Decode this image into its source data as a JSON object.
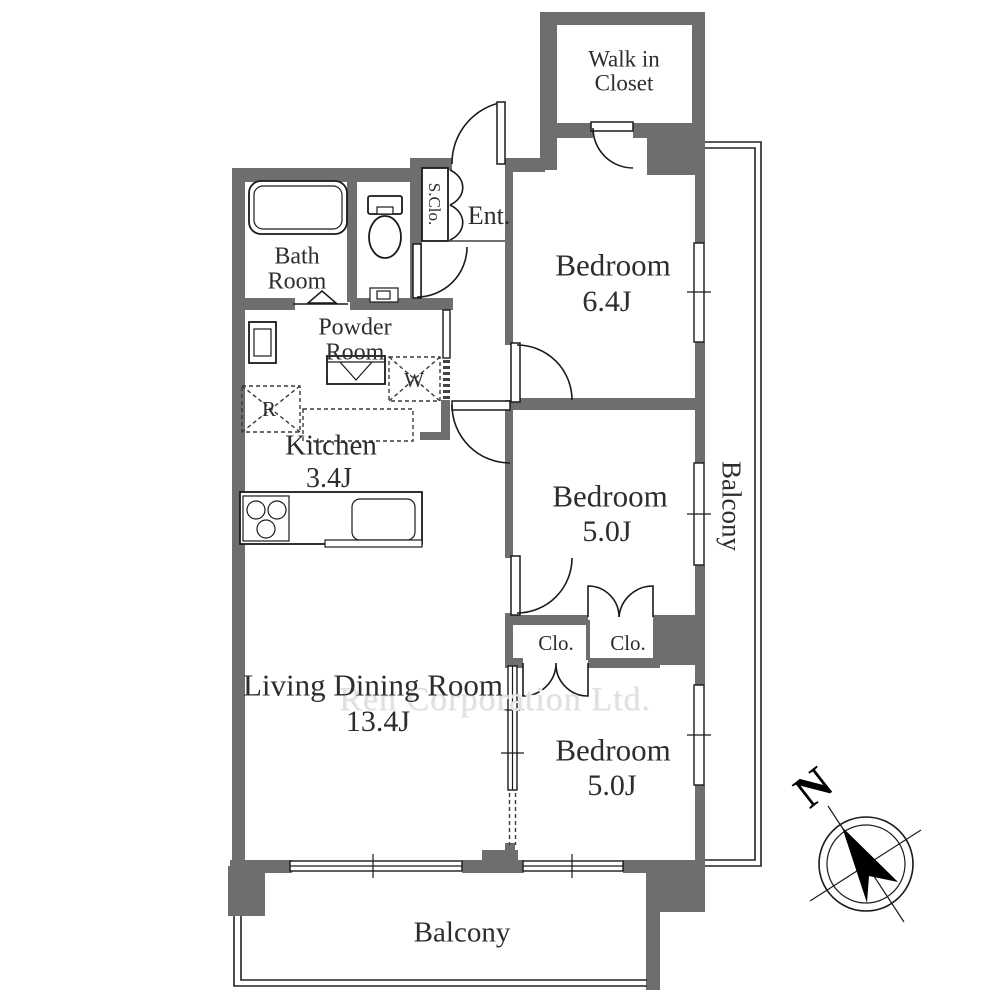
{
  "colors": {
    "wall": "#6e6e6e",
    "line": "#1a1a1a",
    "text": "#2d2d2d",
    "watermark": "#e0e0e0"
  },
  "watermark": "Ren Corporation Ltd.",
  "compass": {
    "north_label": "N"
  },
  "rooms": {
    "walk_in_closet": {
      "label": "Walk in Closet"
    },
    "bedroom_top": {
      "label": "Bedroom",
      "size": "6.4J"
    },
    "bedroom_middle": {
      "label": "Bedroom",
      "size": "5.0J"
    },
    "bedroom_bottom": {
      "label": "Bedroom",
      "size": "5.0J"
    },
    "living_dining": {
      "label": "Living Dining Room",
      "size": "13.4J"
    },
    "kitchen": {
      "label": "Kitchen",
      "size": "3.4J"
    },
    "bath": {
      "label": "Bath Room"
    },
    "powder": {
      "label": "Powder Room"
    },
    "entrance": {
      "label": "Ent."
    },
    "shoe_closet": {
      "label": "S.Clo."
    },
    "closet_left": {
      "label": "Clo."
    },
    "closet_right": {
      "label": "Clo."
    },
    "balcony_side": {
      "label": "Balcony"
    },
    "balcony_bottom": {
      "label": "Balcony"
    }
  },
  "appliances": {
    "washer_label": "W",
    "refrigerator_label": "R"
  }
}
